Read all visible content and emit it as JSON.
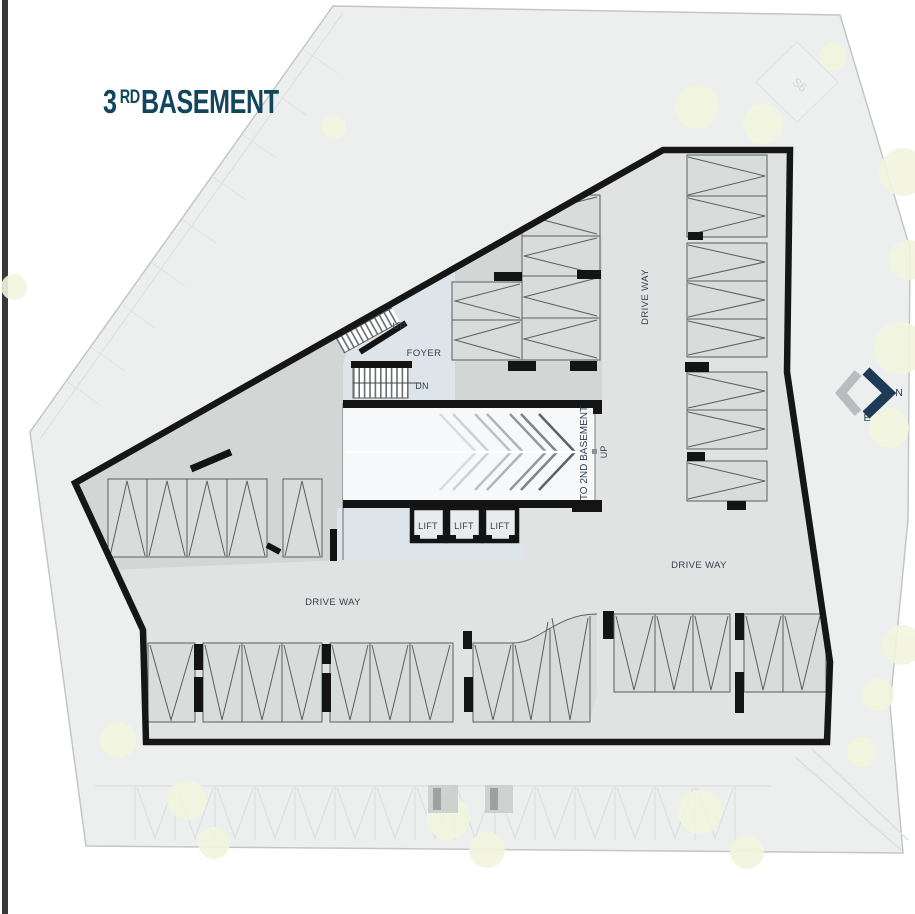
{
  "title": {
    "number": "3",
    "ordinal": "RD",
    "word": "BASEMENT"
  },
  "labels": {
    "up": "UP",
    "dn": "DN",
    "foyer": "FOYER",
    "lifts": [
      "LIFT",
      "LIFT",
      "LIFT"
    ],
    "driveway_west": "DRIVE WAY",
    "driveway_southeast": "DRIVE WAY",
    "driveway_east": "DRIVE WAY",
    "ramp_destination": "TO 2ND BASEMENT",
    "ramp_up": "UP",
    "plot_marker": "S6"
  },
  "compass": {
    "north": "N",
    "east": "E"
  },
  "colors": {
    "title_text": "#12465e",
    "label_text": "#333e4e",
    "wall": "#161616",
    "floor": "#e0e3e2",
    "floor_dark": "#d2d7d6",
    "stall_fill": "#d8dcdb",
    "stall_line": "#5a5e60",
    "foyer_fill": "#dde4ea",
    "ramp_fill": "#f7f8f9",
    "site_fill": "#edefee",
    "tree_fill": "#f2f5dd",
    "compass_north": "#1d3a57",
    "compass_gray": "#b7bcbf"
  }
}
